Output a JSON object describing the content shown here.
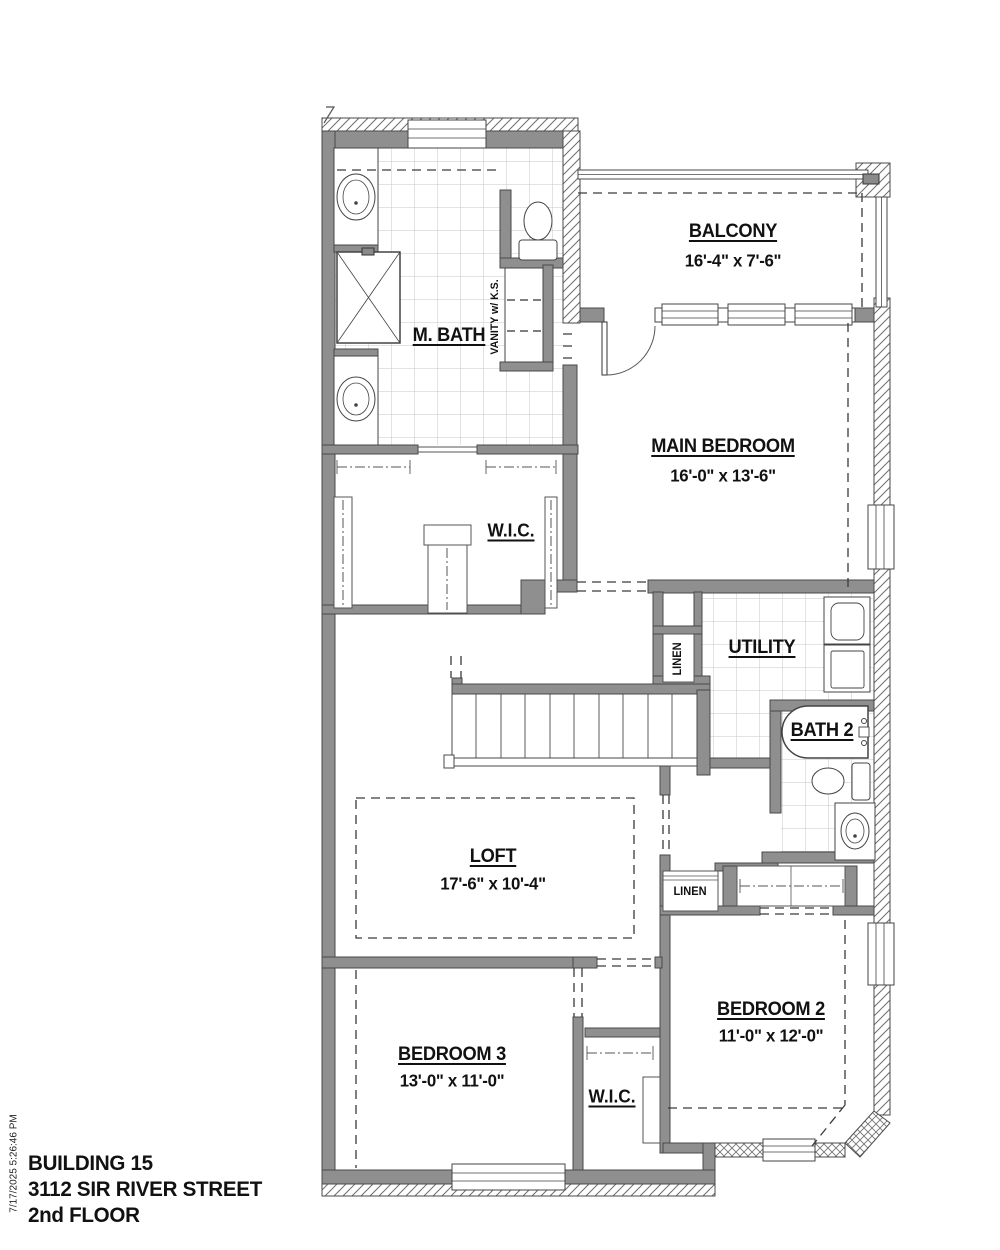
{
  "meta": {
    "timestamp": "7/17/2025 5:26:46 PM"
  },
  "title_block": {
    "building": "BUILDING 15",
    "street": "3112 SIR RIVER STREET",
    "floor": "2nd FLOOR"
  },
  "rooms": {
    "balcony": {
      "name": "BALCONY",
      "dims": "16'-4\" x 7'-6\""
    },
    "m_bath": {
      "name": "M. BATH"
    },
    "vanity": {
      "name": "VANITY w/ K.S."
    },
    "main_bedroom": {
      "name": "MAIN BEDROOM",
      "dims": "16'-0\" x 13'-6\""
    },
    "wic_master": {
      "name": "W.I.C."
    },
    "utility": {
      "name": "UTILITY"
    },
    "linen_utility": {
      "name": "LINEN"
    },
    "bath2": {
      "name": "BATH 2"
    },
    "linen_hall": {
      "name": "LINEN"
    },
    "loft": {
      "name": "LOFT",
      "dims": "17'-6\" x 10'-4\""
    },
    "bedroom2": {
      "name": "BEDROOM 2",
      "dims": "11'-0\" x 12'-0\""
    },
    "bedroom3": {
      "name": "BEDROOM 3",
      "dims": "13'-0\" x 11'-0\""
    },
    "wic_bedroom3": {
      "name": "W.I.C."
    }
  },
  "colors": {
    "wall": "#8f8f8f",
    "line": "#4a4a4a",
    "tile_line": "#c7c7c7",
    "text": "#111111"
  }
}
